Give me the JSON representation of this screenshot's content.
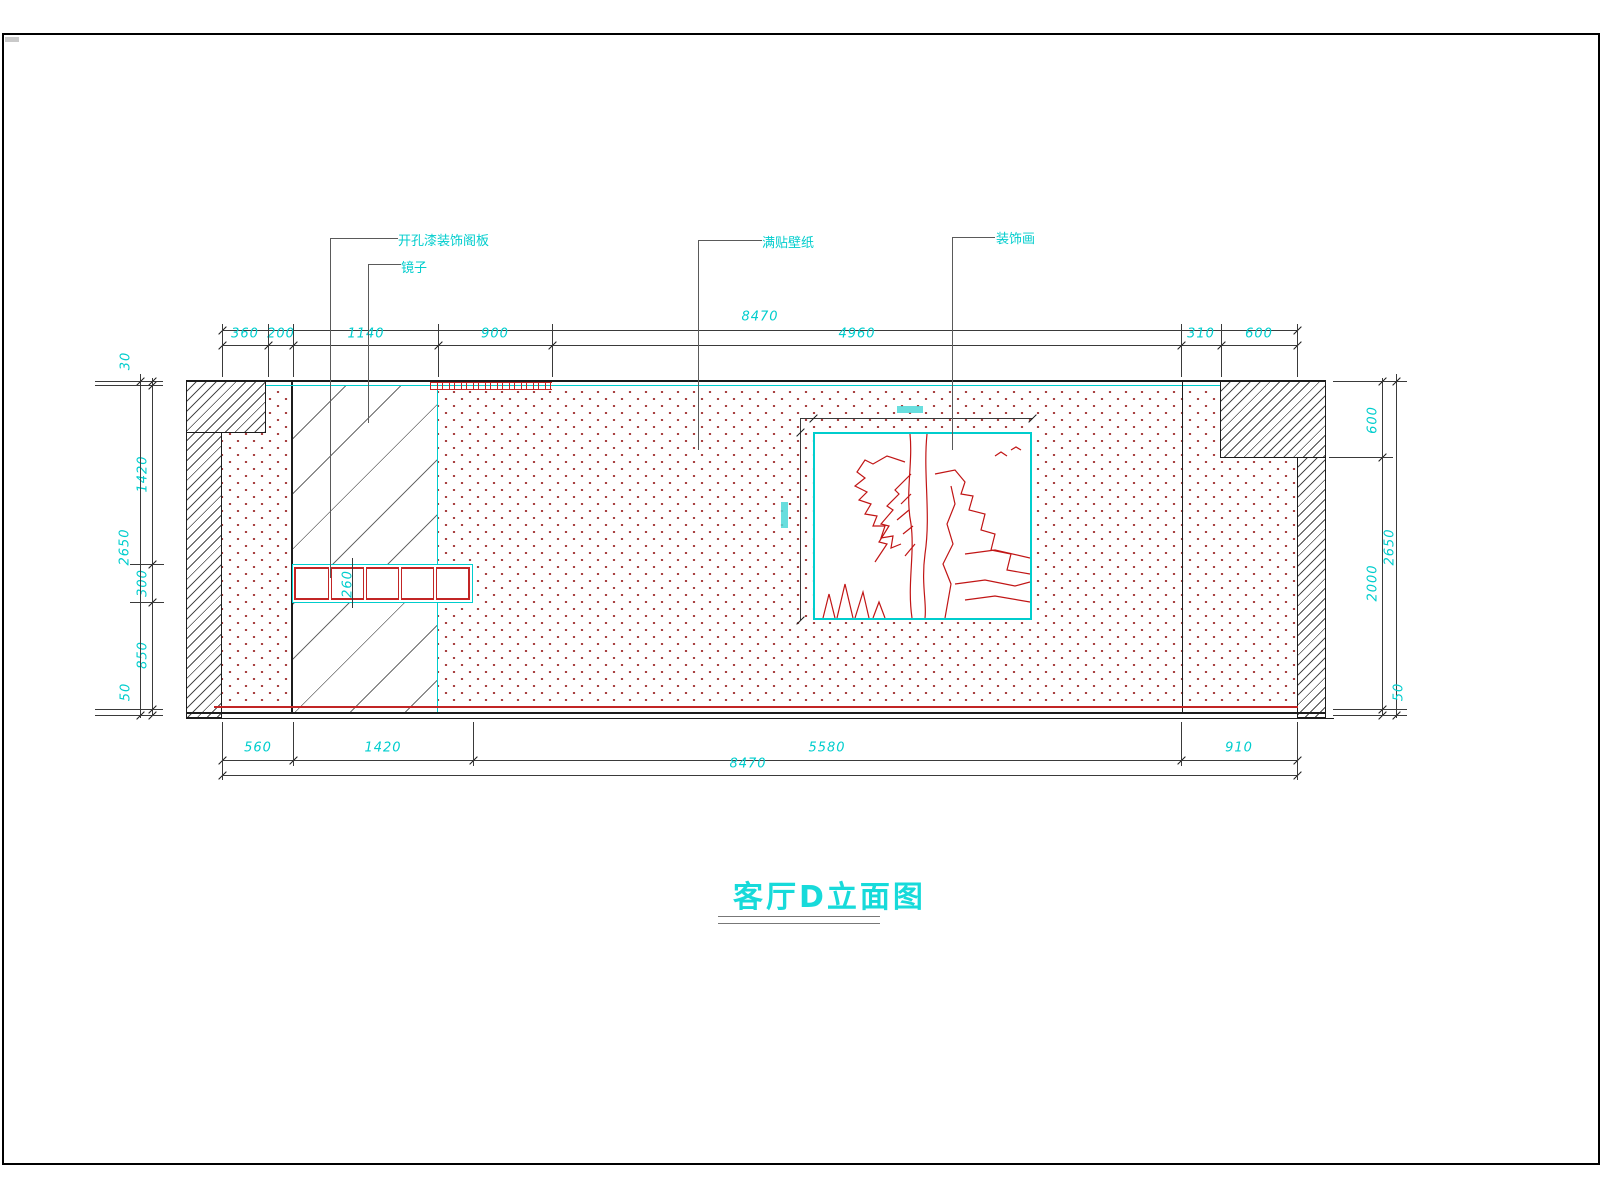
{
  "page": {
    "title": "客厅D立面图"
  },
  "annotations": {
    "panel": "开孔漆装饰阁板",
    "mirror": "镜子",
    "wallpaper": "满贴壁纸",
    "painting": "装饰画"
  },
  "colors": {
    "cyan": "#00cdcd",
    "red": "#c22525",
    "stipple_dot": "#a03030",
    "line": "#1c1c1c",
    "leader": "#5a5a5a"
  },
  "dims": {
    "h_chains": [
      {
        "y": 330,
        "x1": 222,
        "x2": 1297,
        "ticks": [
          222,
          1297
        ],
        "labels": [
          {
            "t": "8470",
            "cx": 760,
            "cy": 317
          }
        ]
      },
      {
        "y": 345,
        "x1": 222,
        "x2": 1297,
        "ticks": [
          222,
          268,
          293,
          438,
          552,
          1181,
          1221,
          1297
        ],
        "labels": [
          {
            "t": "360",
            "cx": 245,
            "cy": 334
          },
          {
            "t": "200",
            "cx": 281,
            "cy": 334
          },
          {
            "t": "1140",
            "cx": 366,
            "cy": 334
          },
          {
            "t": "900",
            "cx": 495,
            "cy": 334
          },
          {
            "t": "4960",
            "cx": 857,
            "cy": 334
          },
          {
            "t": "310",
            "cx": 1201,
            "cy": 334
          },
          {
            "t": "600",
            "cx": 1259,
            "cy": 334
          }
        ]
      },
      {
        "y": 760,
        "x1": 222,
        "x2": 1297,
        "ticks": [
          222,
          293,
          473,
          1181,
          1297
        ],
        "labels": [
          {
            "t": "560",
            "cx": 258,
            "cy": 748
          },
          {
            "t": "1420",
            "cx": 383,
            "cy": 748
          },
          {
            "t": "5580",
            "cx": 827,
            "cy": 748
          },
          {
            "t": "910",
            "cx": 1239,
            "cy": 748
          }
        ]
      },
      {
        "y": 775,
        "x1": 222,
        "x2": 1297,
        "ticks": [
          222,
          1297
        ],
        "labels": [
          {
            "t": "8470",
            "cx": 748,
            "cy": 764
          }
        ]
      }
    ],
    "v_chains": [
      {
        "x": 152,
        "y1": 378,
        "y2": 715,
        "ticks": [
          381,
          385,
          564,
          602,
          709,
          715
        ],
        "labels": [
          {
            "t": "1420",
            "cx": 143,
            "cy": 474
          },
          {
            "t": "300",
            "cx": 143,
            "cy": 583
          },
          {
            "t": "850",
            "cx": 143,
            "cy": 655
          }
        ]
      },
      {
        "x": 140,
        "y1": 374,
        "y2": 718,
        "ticks": [
          381,
          715
        ],
        "labels": [
          {
            "t": "30",
            "cx": 126,
            "cy": 361
          },
          {
            "t": "2650",
            "cx": 125,
            "cy": 547
          },
          {
            "t": "50",
            "cx": 126,
            "cy": 692
          }
        ]
      },
      {
        "x": 1382,
        "y1": 378,
        "y2": 715,
        "ticks": [
          381,
          457,
          709,
          715
        ],
        "labels": [
          {
            "t": "600",
            "cx": 1373,
            "cy": 420
          },
          {
            "t": "2000",
            "cx": 1373,
            "cy": 583
          }
        ]
      },
      {
        "x": 1396,
        "y1": 374,
        "y2": 718,
        "ticks": [
          381,
          715
        ],
        "labels": [
          {
            "t": "2650",
            "cx": 1390,
            "cy": 547
          },
          {
            "t": "50",
            "cx": 1399,
            "cy": 692
          }
        ]
      }
    ],
    "shelf_label": {
      "t": "260",
      "cx": 348,
      "cy": 584
    },
    "ext_lines": [
      [
        222,
        324,
        1,
        53
      ],
      [
        268,
        324,
        1,
        53
      ],
      [
        293,
        324,
        1,
        53
      ],
      [
        438,
        324,
        1,
        53
      ],
      [
        552,
        324,
        1,
        53
      ],
      [
        1181,
        324,
        1,
        53
      ],
      [
        1221,
        324,
        1,
        53
      ],
      [
        1297,
        324,
        1,
        53
      ],
      [
        222,
        722,
        1,
        58
      ],
      [
        293,
        722,
        1,
        44
      ],
      [
        473,
        722,
        1,
        44
      ],
      [
        1181,
        722,
        1,
        44
      ],
      [
        1297,
        722,
        1,
        58
      ],
      [
        95,
        381,
        68,
        1
      ],
      [
        95,
        385,
        68,
        1
      ],
      [
        130,
        564,
        34,
        1
      ],
      [
        130,
        602,
        34,
        1
      ],
      [
        95,
        709,
        68,
        1
      ],
      [
        95,
        715,
        68,
        1
      ],
      [
        1333,
        381,
        74,
        1
      ],
      [
        1329,
        457,
        64,
        1
      ],
      [
        1333,
        709,
        74,
        1
      ],
      [
        1333,
        715,
        74,
        1
      ],
      [
        800,
        418,
        233,
        1
      ],
      [
        800,
        418,
        1,
        202
      ],
      [
        352,
        558,
        1,
        50
      ]
    ],
    "free_ticks": [
      [
        813,
        418
      ],
      [
        1032,
        418
      ],
      [
        800,
        432
      ],
      [
        800,
        620
      ]
    ],
    "leader_lines": [
      [
        330,
        238,
        68,
        1
      ],
      [
        330,
        238,
        1,
        340
      ],
      [
        368,
        264,
        33,
        1
      ],
      [
        368,
        264,
        1,
        159
      ],
      [
        698,
        240,
        64,
        1
      ],
      [
        698,
        240,
        1,
        210
      ],
      [
        952,
        237,
        43,
        1
      ],
      [
        952,
        237,
        1,
        213
      ]
    ]
  }
}
